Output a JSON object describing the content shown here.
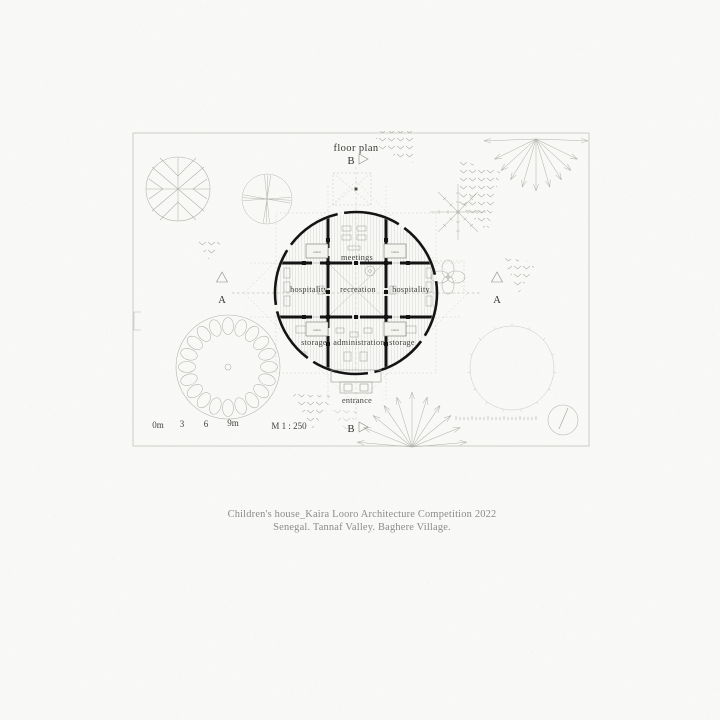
{
  "plan": {
    "title": "floor plan",
    "section_marker_a": "A",
    "section_marker_b": "B",
    "rooms": {
      "meetings": "meetings",
      "hospitality": "hospitality",
      "recreation": "recreation",
      "storage": "storage",
      "administration": "administration",
      "entrance": "entrance",
      "toilets": "toilets"
    },
    "scale": {
      "tick0": "0m",
      "tick1": "3",
      "tick2": "6",
      "tick3": "9m",
      "ratio": "M 1 : 250"
    },
    "colors": {
      "ink": "#1c1c1c",
      "faint_line": "#b4b4ae",
      "paper": "#fafaf8",
      "caption_text": "#8b8b8a"
    }
  },
  "caption": {
    "line1": "Children's house_Kaira Looro Architecture Competition 2022",
    "line2": "Senegal. Tannaf Valley. Baghere Village."
  }
}
